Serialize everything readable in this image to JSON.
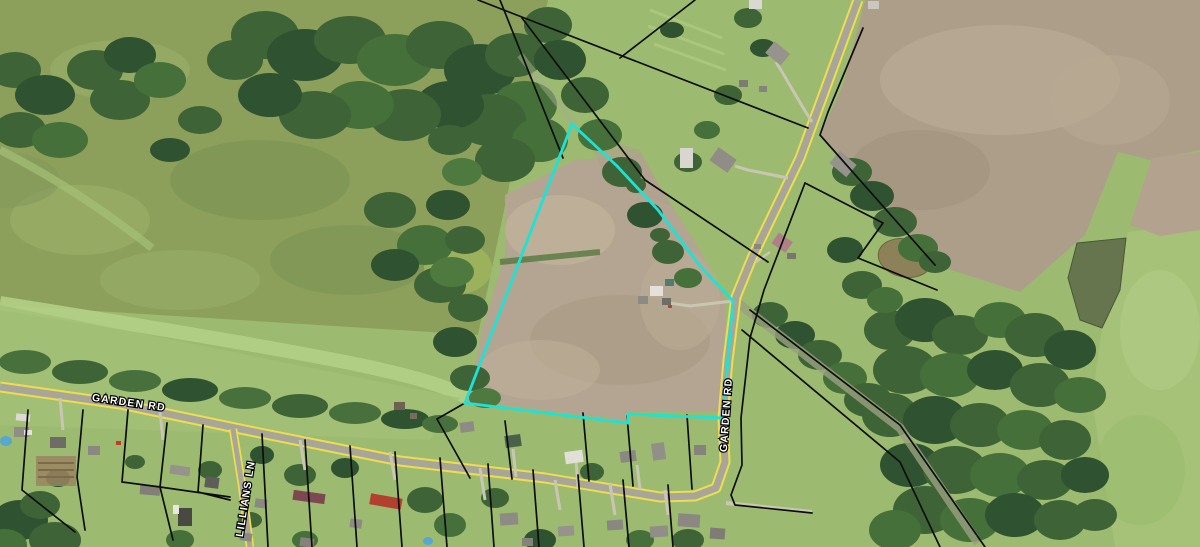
{
  "map": {
    "type": "aerial-parcel-map",
    "road_labels": {
      "garden_rd_west": "GARDEN RD",
      "garden_rd_south": "GARDEN RD",
      "lillians_ln": "LILLIANS LN"
    },
    "roads": [
      {
        "name": "GARDEN RD",
        "style": "yellow-edged gray road"
      },
      {
        "name": "LILLIANS LN",
        "style": "yellow-edged gray road"
      }
    ],
    "highlight_parcel": {
      "outline_color": "#1DE2D6",
      "points": "572,124 617,166 658,210 700,266 733,301 729,345 723,418 628,414 628,423 465,403"
    },
    "features": {
      "ponds": 2,
      "plowed_fields": 2,
      "subdivision_lots": "along Garden Rd south side",
      "railroad_corridor_trace": "diagonal cleared strip NW-SE through road junction"
    },
    "colors": {
      "parcel_boundary": "#0d0d0d",
      "road_edge_yellow": "#EFDC4F",
      "road_surface": "#A7A699",
      "field_tan": "#B2A38D",
      "field_green": "#9CBB70",
      "olive_field": "#8CA05C",
      "forest_green": "#3E6336",
      "water": "#66754E",
      "highlight": "#1DE2D6"
    }
  }
}
